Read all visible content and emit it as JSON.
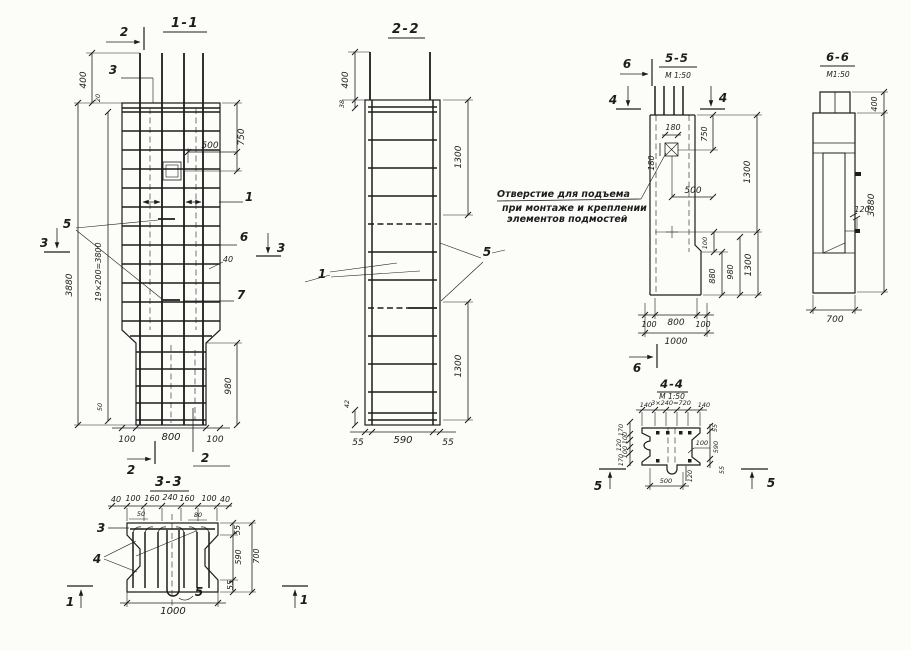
{
  "drawing": {
    "note": [
      "Отверстие для подъема",
      "при монтаже и креплении",
      "элементов подмостей"
    ],
    "s11": {
      "title": "1-1",
      "m2top": "2",
      "m2bot": "2",
      "cut2": "2",
      "lead3": "3",
      "m3left": "3",
      "m3right": "3",
      "d400": "400",
      "d20": "20",
      "d3880": "3880",
      "d19x200": "19×200=3800",
      "d50": "50",
      "d750": "750",
      "d500": "500",
      "d40": "40",
      "d980": "980",
      "d100l": "100",
      "d800": "800",
      "d100r": "100",
      "c1": "1",
      "c5": "5",
      "c6": "6",
      "c7": "7"
    },
    "s22": {
      "title": "2-2",
      "d400": "400",
      "d38": "38",
      "d1300u": "1300",
      "d1300l": "1300",
      "d42": "42",
      "d55l": "55",
      "d590": "590",
      "d55r": "55",
      "c1": "1",
      "c5": "5"
    },
    "s33": {
      "title": "3-3",
      "top": [
        "40",
        "100",
        "160",
        "240",
        "160",
        "100",
        "40"
      ],
      "sub50": "50",
      "sub80": "80",
      "d55t": "55",
      "d590": "590",
      "d55b": "55",
      "d700": "700",
      "d1000": "1000",
      "c3": "3",
      "c4": "4",
      "c5": "5",
      "m1left": "1",
      "m1right": "1"
    },
    "s44": {
      "title": "4-4",
      "scale": "М 1:50",
      "d140l": "140",
      "d240": "3×240=720",
      "d140r": "140",
      "d55t": "55",
      "d590": "590",
      "d55b": "55",
      "left": [
        "170",
        "100",
        "120",
        "100",
        "170"
      ],
      "d100": "100",
      "d500": "500",
      "d120": "120",
      "m5left": "5",
      "m5right": "5"
    },
    "s55": {
      "title": "5-5",
      "scale": "М 1:50",
      "m6top": "6",
      "m4left": "4",
      "m4right": "4",
      "m6bot": "6",
      "d180h": "180",
      "d180v": "180",
      "d750": "750",
      "d1300u": "1300",
      "d500": "500",
      "d100s": "100",
      "d880": "880",
      "d980": "980",
      "d1300l": "1300",
      "d100l": "100",
      "d800": "800",
      "d100r": "100",
      "d1000": "1000"
    },
    "s66": {
      "title": "6-6",
      "scale": "М1:50",
      "d400": "400",
      "d3880": "3880",
      "d120": "120",
      "d700": "700"
    }
  }
}
